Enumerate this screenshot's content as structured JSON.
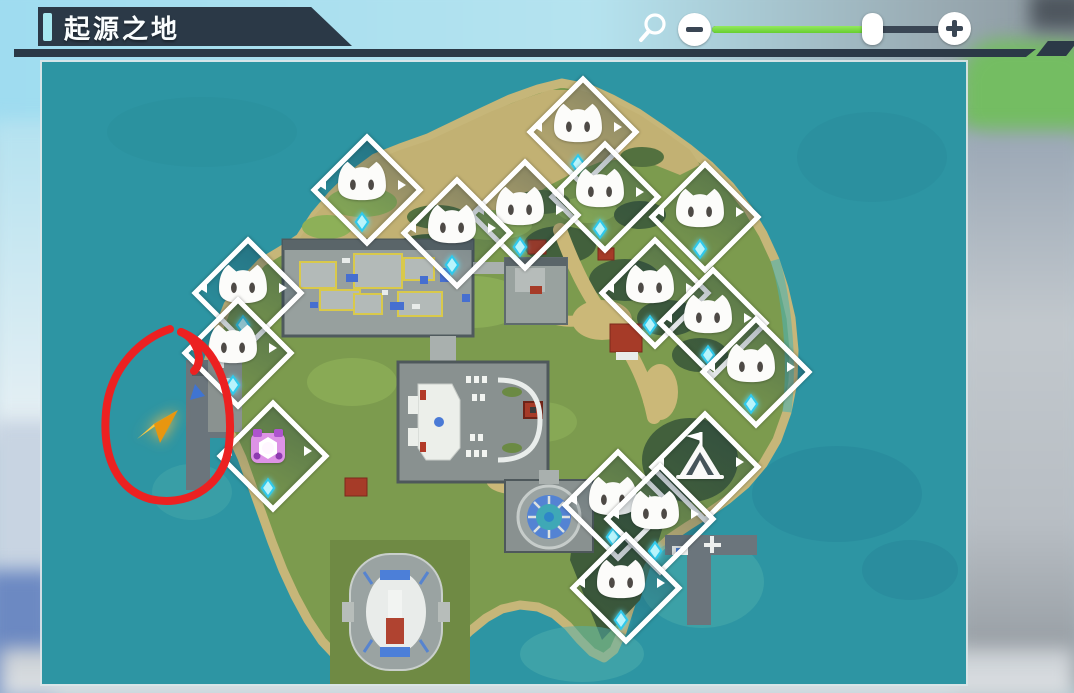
{
  "header": {
    "title": "起源之地",
    "panel_color": "#2b3947",
    "accent_color": "#a7e8f0"
  },
  "zoom_control": {
    "value_percent": 70,
    "fill_color": "#7ee14a",
    "magnifier_icon": "magnifier",
    "decrease_label": "−",
    "increase_label": "+"
  },
  "map": {
    "name": "origin-land-map",
    "ocean_color": "#2d95a3",
    "markers": [
      {
        "type": "cat",
        "x": 536,
        "y": 65,
        "gem": true
      },
      {
        "type": "cat",
        "x": 320,
        "y": 123,
        "gem": true
      },
      {
        "type": "cat",
        "x": 558,
        "y": 130,
        "gem": true
      },
      {
        "type": "cat",
        "x": 478,
        "y": 148,
        "gem": true
      },
      {
        "type": "cat",
        "x": 658,
        "y": 150,
        "gem": true
      },
      {
        "type": "cat",
        "x": 410,
        "y": 166,
        "gem": true
      },
      {
        "type": "cat",
        "x": 201,
        "y": 226,
        "gem": true
      },
      {
        "type": "cat",
        "x": 608,
        "y": 226,
        "gem": true
      },
      {
        "type": "cat",
        "x": 666,
        "y": 256,
        "gem": true
      },
      {
        "type": "cat",
        "x": 191,
        "y": 286,
        "gem": true
      },
      {
        "type": "cat",
        "x": 709,
        "y": 305,
        "gem": true
      },
      {
        "type": "portal",
        "x": 226,
        "y": 389,
        "gem": true
      },
      {
        "type": "tent",
        "x": 658,
        "y": 400,
        "gem": false
      },
      {
        "type": "cat",
        "x": 571,
        "y": 438,
        "gem": true
      },
      {
        "type": "cat",
        "x": 613,
        "y": 452,
        "gem": true
      },
      {
        "type": "cat",
        "x": 579,
        "y": 521,
        "gem": true
      }
    ],
    "annotation": {
      "shape": "hand-drawn-circle",
      "circle_color": "#ec2121",
      "arrow_color_light": "#ffc93e",
      "arrow_color_dark": "#e8960f",
      "center_x": 127,
      "center_y": 350
    }
  }
}
